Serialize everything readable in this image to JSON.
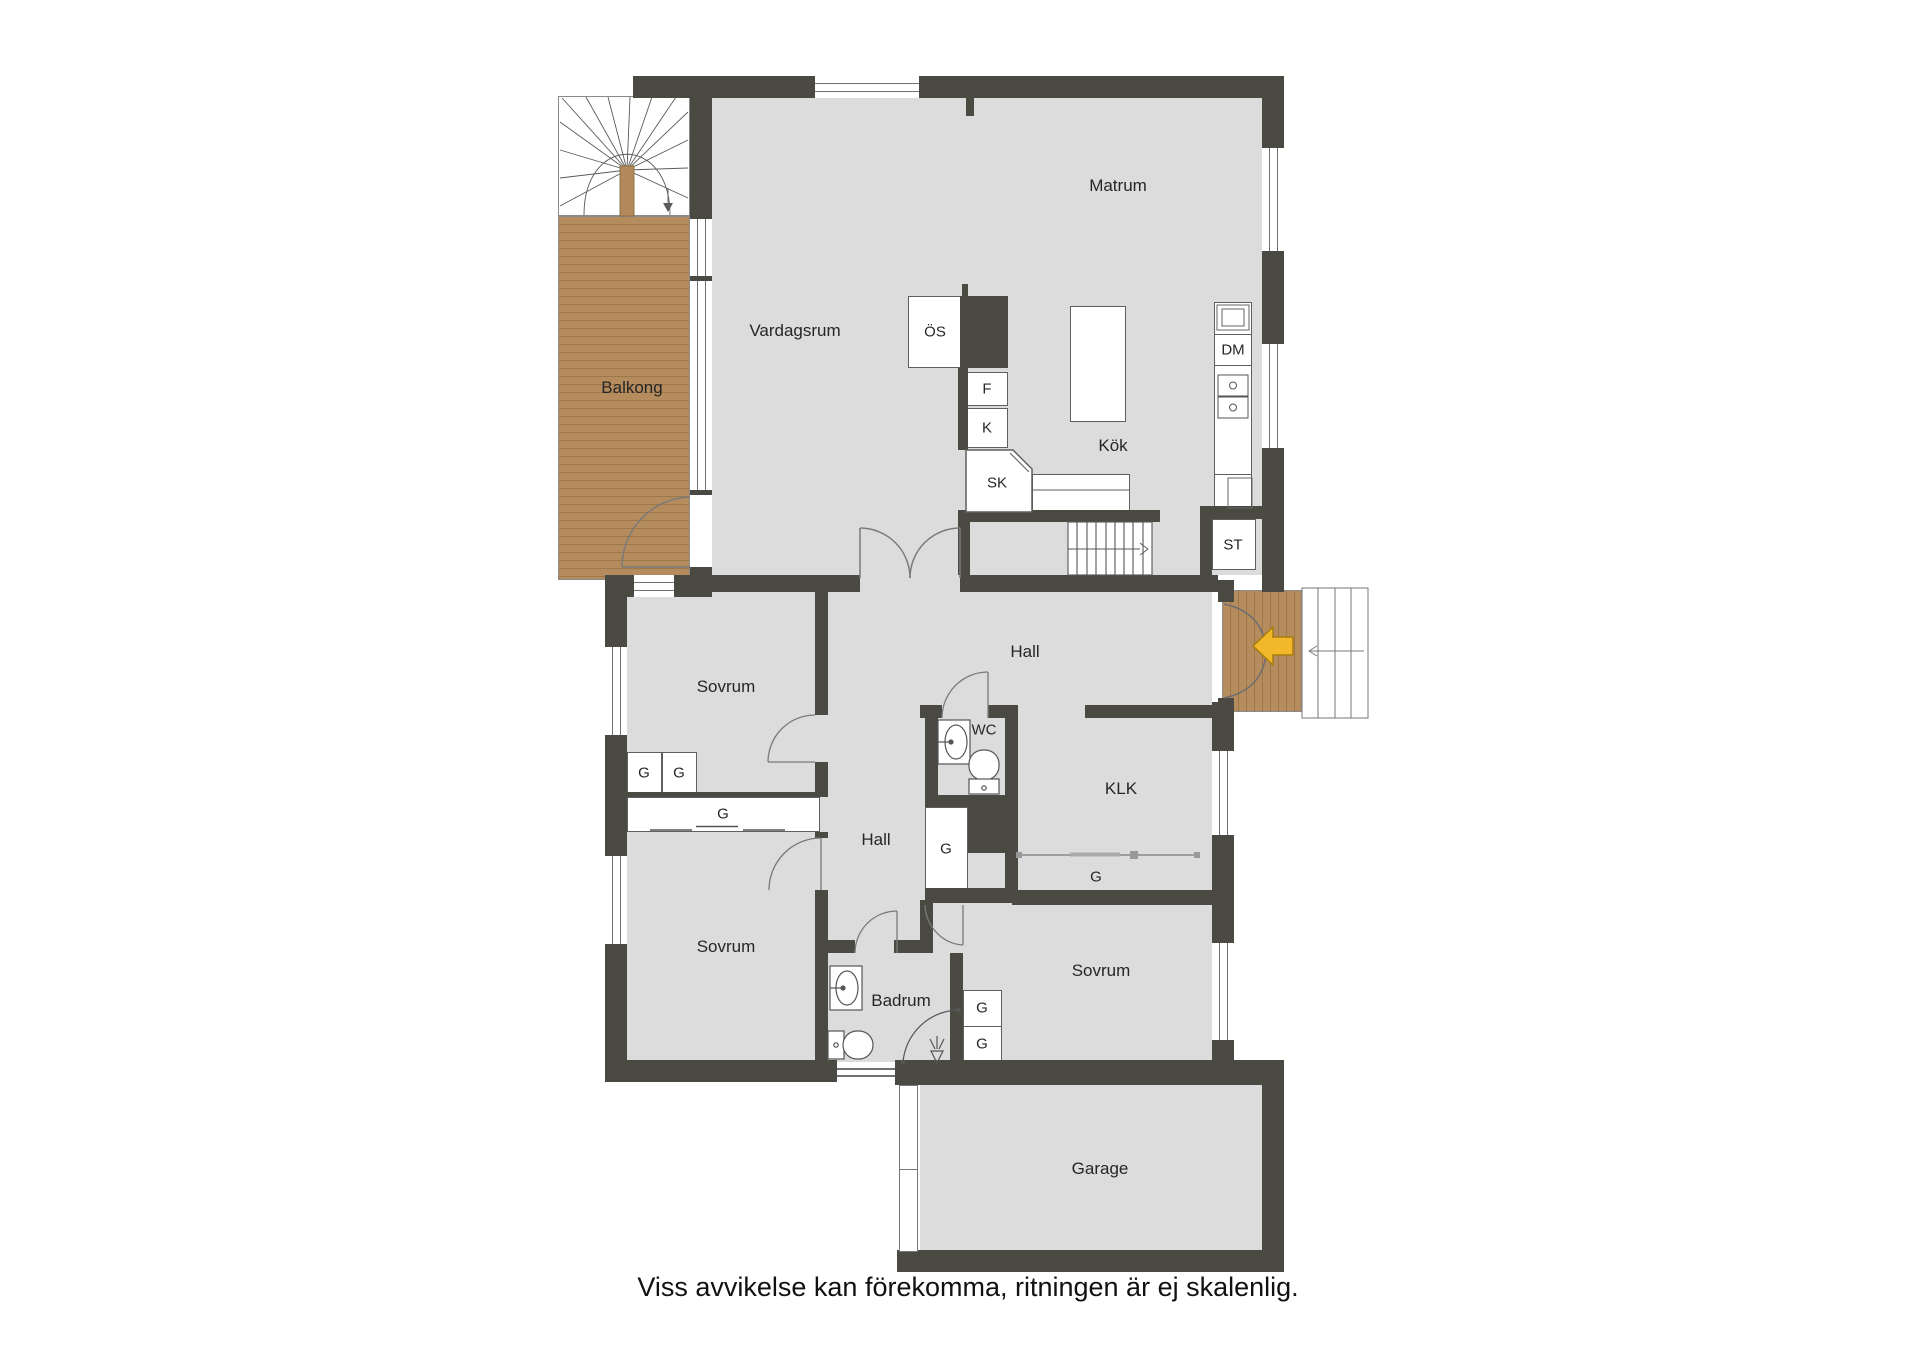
{
  "rooms": {
    "matrum": "Matrum",
    "vardagsrum": "Vardagsrum",
    "balkong": "Balkong",
    "kok": "Kök",
    "hall_upper": "Hall",
    "hall_lower": "Hall",
    "sovrum_1": "Sovrum",
    "sovrum_2": "Sovrum",
    "sovrum_3": "Sovrum",
    "wc": "WC",
    "klk": "KLK",
    "badrum": "Badrum",
    "garage": "Garage"
  },
  "fixtures": {
    "os": "ÖS",
    "f": "F",
    "k": "K",
    "sk": "SK",
    "dm": "DM",
    "st": "ST",
    "g": "G"
  },
  "caption": "Viss avvikelse kan förekomma, ritningen är ej skalenlig.",
  "colors": {
    "wall": "#4a4a43",
    "floor": "#dcdcdd",
    "wood": "#b58c5e",
    "entrance_arrow": "#f3b82a"
  }
}
